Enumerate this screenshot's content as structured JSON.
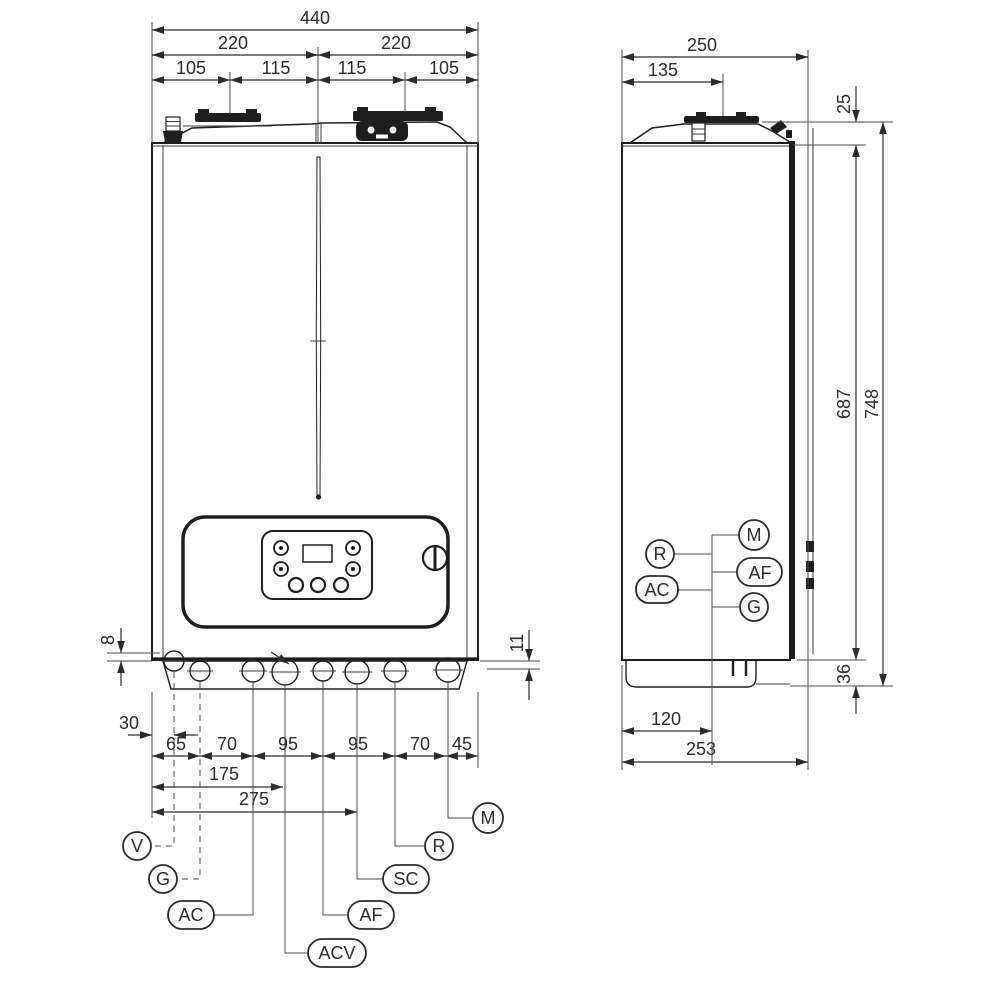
{
  "front_view": {
    "top_dims": {
      "total": "440",
      "half_left": "220",
      "half_right": "220",
      "s1": "105",
      "s2": "115",
      "s3": "115",
      "s4": "105"
    },
    "bottom_dims": {
      "valve_offset": "30",
      "valve_drop": "8",
      "pipe_drop": "11",
      "chain": [
        "65",
        "70",
        "95",
        "95",
        "70",
        "45"
      ],
      "to_acv": "175",
      "to_sc": "275"
    },
    "connections": [
      "V",
      "G",
      "AC",
      "ACV",
      "AF",
      "SC",
      "R",
      "M"
    ]
  },
  "side_view": {
    "dims": {
      "depth": "250",
      "flue_offset": "135",
      "top_clearance": "25",
      "casing_height": "687",
      "total_height": "748",
      "base_height": "36",
      "conn_offset": "120",
      "total_depth": "253"
    },
    "connections": [
      "R",
      "AC",
      "M",
      "AF",
      "G"
    ]
  }
}
